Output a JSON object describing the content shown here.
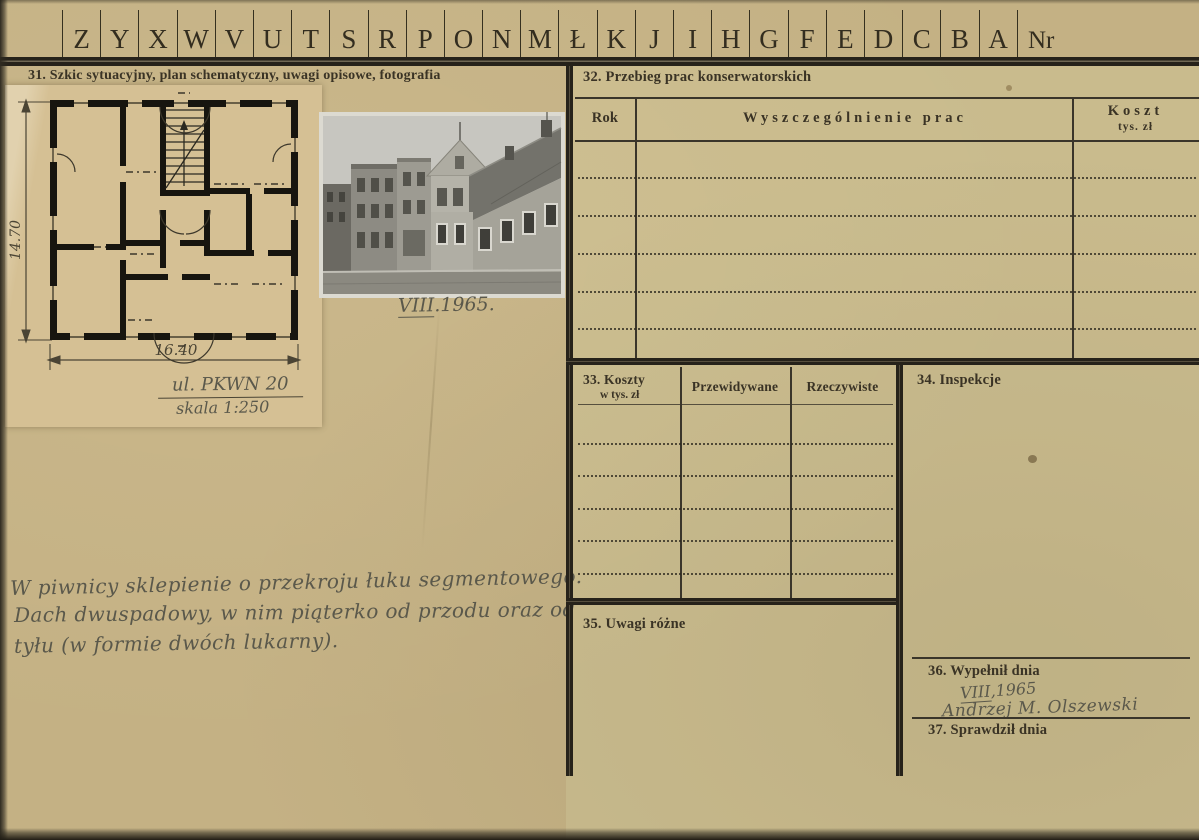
{
  "colors": {
    "paper": "#c4b184",
    "right_paper_tint": "#cdc291",
    "ink": "#3a3325",
    "pencil": "#5a584b",
    "rule": "#26221a"
  },
  "index_row": {
    "letters": [
      "Z",
      "Y",
      "X",
      "W",
      "V",
      "U",
      "T",
      "S",
      "R",
      "P",
      "O",
      "N",
      "M",
      "Ł",
      "K",
      "J",
      "I",
      "H",
      "G",
      "F",
      "E",
      "D",
      "C",
      "B",
      "A"
    ],
    "nr_label": "Nr"
  },
  "section31": {
    "title": "31. Szkic sytuacyjny, plan schematyczny, uwagi opisowe, fotografia",
    "plan": {
      "height_label": "14.70",
      "width_label": "16.40",
      "address": "ul. PKWN 20",
      "scale": "skala 1:250"
    },
    "photo_caption": {
      "roman": "VIII",
      "rest": ".1965."
    },
    "notes": {
      "line1": "W piwnicy sklepienie o przekroju łuku segmentowego.",
      "line2": "Dach dwuspadowy, w nim piąterko od  przodu oraz od",
      "line3": "tyłu (w formie dwóch lukarny)."
    }
  },
  "section32": {
    "title": "32. Przebieg prac konserwatorskich",
    "col_rok": "Rok",
    "col_works": "Wyszczególnienie prac",
    "col_cost": "Koszt",
    "col_cost_sub": "tys. zł",
    "empty_rows": 5
  },
  "section33": {
    "title": "33. Koszty",
    "subtitle": "w tys. zł",
    "col_expected": "Przewidywane",
    "col_actual": "Rzeczywiste",
    "empty_rows": 5
  },
  "section34": {
    "title": "34. Inspekcje"
  },
  "section35": {
    "title": "35. Uwagi różne"
  },
  "section36": {
    "title": "36. Wypełnił dnia",
    "date_roman": "VIII",
    "date_rest": ",1965",
    "signature": "Andrzej M. Olszewski"
  },
  "section37": {
    "title": "37. Sprawdził dnia"
  }
}
